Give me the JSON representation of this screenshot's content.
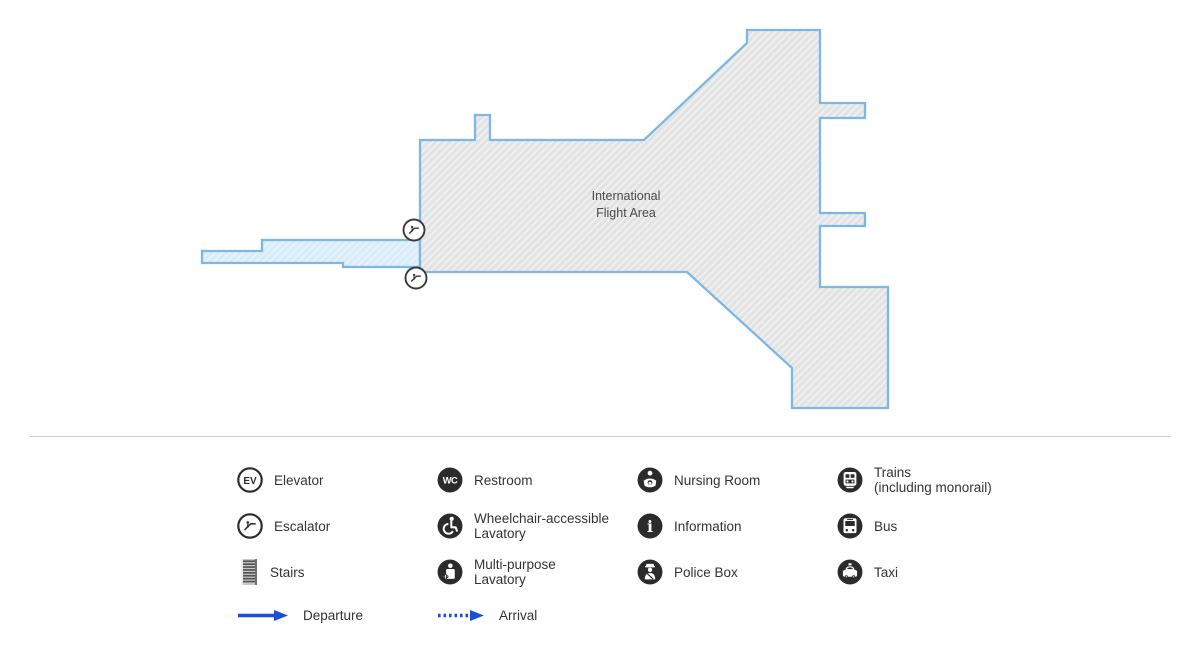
{
  "map": {
    "area_label_line1": "International",
    "area_label_line2": "Flight Area",
    "map_icons": [
      {
        "name": "escalator-map-icon-upper"
      },
      {
        "name": "escalator-map-icon-lower"
      }
    ],
    "colors": {
      "border_blue": "#7db7e4",
      "body_fill": "#e3e3e3",
      "walkway_fill": "#d9ecf9",
      "label_text": "#4a4a4a"
    }
  },
  "legend": {
    "items": [
      {
        "icon": "elevator-icon",
        "label": "Elevator"
      },
      {
        "icon": "escalator-icon",
        "label": "Escalator"
      },
      {
        "icon": "stairs-icon",
        "label": "Stairs"
      },
      {
        "icon": "departure-arrow",
        "label": "Departure"
      },
      {
        "icon": "restroom-icon",
        "label": "Restroom"
      },
      {
        "icon": "wheelchair-lavatory-icon",
        "label": "Wheelchair-accessible",
        "label2": "Lavatory"
      },
      {
        "icon": "multipurpose-lavatory-icon",
        "label": "Multi-purpose",
        "label2": "Lavatory"
      },
      {
        "icon": "arrival-arrow",
        "label": "Arrival"
      },
      {
        "icon": "nursing-room-icon",
        "label": "Nursing Room"
      },
      {
        "icon": "information-icon",
        "label": "Information"
      },
      {
        "icon": "police-box-icon",
        "label": "Police Box"
      },
      {
        "icon": "trains-icon",
        "label": "Trains",
        "label2": "(including monorail)"
      },
      {
        "icon": "bus-icon",
        "label": "Bus"
      },
      {
        "icon": "taxi-icon",
        "label": "Taxi"
      }
    ],
    "icon_texts": {
      "elevator": "EV",
      "restroom": "WC",
      "information": "i"
    },
    "colors": {
      "icon_dark": "#2b2b2b",
      "arrow_blue": "#1a4fd8",
      "label_text": "#333333",
      "divider": "#cbcbcb"
    }
  }
}
